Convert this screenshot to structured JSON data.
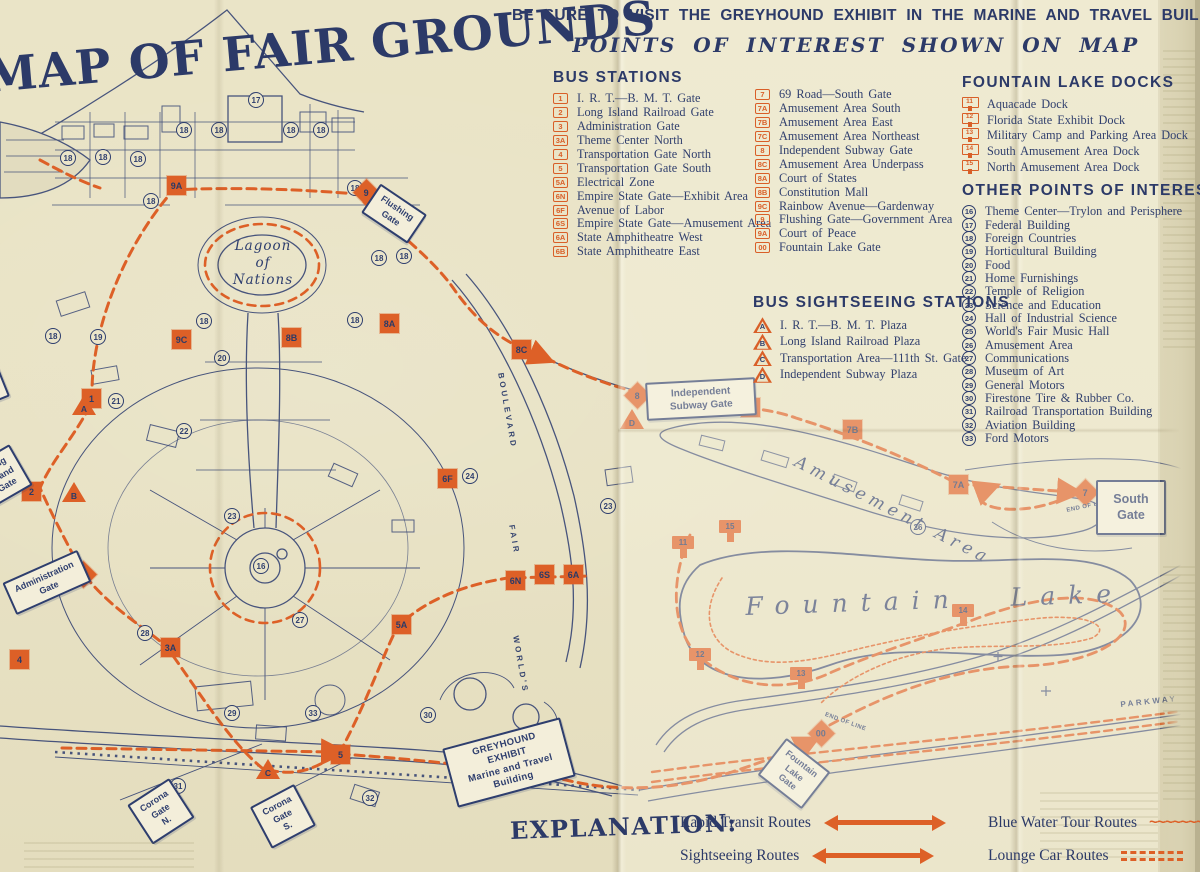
{
  "palette": {
    "paper": "#e9e3c6",
    "ink": "#2e3e6e",
    "orange": "#dd6027",
    "sign_bg": "#f3eeda"
  },
  "title": "MAP OF FAIR GROUNDS",
  "banner": {
    "line1": "BE SURE TO VISIT THE GREYHOUND EXHIBIT IN THE MARINE AND TRAVEL BUILDING",
    "line2": "POINTS OF INTEREST SHOWN ON MAP"
  },
  "legend": {
    "bus_stations": {
      "title": "BUS STATIONS",
      "items": [
        {
          "badge": "1",
          "label": "I. R. T.—B. M. T. Gate"
        },
        {
          "badge": "2",
          "label": "Long Island Railroad Gate"
        },
        {
          "badge": "3",
          "label": "Administration Gate"
        },
        {
          "badge": "3A",
          "label": "Theme Center North"
        },
        {
          "badge": "4",
          "label": "Transportation Gate North"
        },
        {
          "badge": "5",
          "label": "Transportation Gate South"
        },
        {
          "badge": "5A",
          "label": "Electrical Zone"
        },
        {
          "badge": "6N",
          "label": "Empire State Gate—Exhibit Area"
        },
        {
          "badge": "6F",
          "label": "Avenue of Labor"
        },
        {
          "badge": "6S",
          "label": "Empire State Gate—Amusement Area"
        },
        {
          "badge": "6A",
          "label": "State Amphitheatre West"
        },
        {
          "badge": "6B",
          "label": "State Amphitheatre East"
        }
      ],
      "items_col2": [
        {
          "badge": "7",
          "label": "69 Road—South Gate"
        },
        {
          "badge": "7A",
          "label": "Amusement Area South"
        },
        {
          "badge": "7B",
          "label": "Amusement Area East"
        },
        {
          "badge": "7C",
          "label": "Amusement Area Northeast"
        },
        {
          "badge": "8",
          "label": "Independent Subway Gate"
        },
        {
          "badge": "8C",
          "label": "Amusement Area Underpass"
        },
        {
          "badge": "8A",
          "label": "Court of States"
        },
        {
          "badge": "8B",
          "label": "Constitution Mall"
        },
        {
          "badge": "9C",
          "label": "Rainbow Avenue—Gardenway"
        },
        {
          "badge": "9",
          "label": "Flushing Gate—Government Area"
        },
        {
          "badge": "9A",
          "label": "Court of Peace"
        },
        {
          "badge": "00",
          "label": "Fountain Lake Gate"
        }
      ]
    },
    "bus_sightseeing": {
      "title": "BUS SIGHTSEEING STATIONS",
      "items": [
        {
          "badge": "A",
          "label": "I. R. T.—B. M. T. Plaza"
        },
        {
          "badge": "B",
          "label": "Long Island Railroad Plaza"
        },
        {
          "badge": "C",
          "label": "Transportation Area—111th St. Gate"
        },
        {
          "badge": "D",
          "label": "Independent Subway Plaza"
        }
      ]
    },
    "fountain_lake_docks": {
      "title": "FOUNTAIN LAKE DOCKS",
      "items": [
        {
          "badge": "11",
          "label": "Aquacade Dock"
        },
        {
          "badge": "12",
          "label": "Florida State Exhibit Dock"
        },
        {
          "badge": "13",
          "label": "Military Camp and Parking Area Dock"
        },
        {
          "badge": "14",
          "label": "South Amusement Area Dock"
        },
        {
          "badge": "15",
          "label": "North Amusement Area Dock"
        }
      ]
    },
    "other_points": {
      "title": "OTHER POINTS OF INTEREST",
      "items": [
        {
          "badge": "16",
          "label": "Theme Center—Trylon and Perisphere"
        },
        {
          "badge": "17",
          "label": "Federal Building"
        },
        {
          "badge": "18",
          "label": "Foreign Countries"
        },
        {
          "badge": "19",
          "label": "Horticultural Building"
        },
        {
          "badge": "20",
          "label": "Food"
        },
        {
          "badge": "21",
          "label": "Home Furnishings"
        },
        {
          "badge": "22",
          "label": "Temple of Religion"
        },
        {
          "badge": "23",
          "label": "Science and Education"
        },
        {
          "badge": "24",
          "label": "Hall of Industrial Science"
        },
        {
          "badge": "25",
          "label": "World's Fair Music Hall"
        },
        {
          "badge": "26",
          "label": "Amusement Area"
        },
        {
          "badge": "27",
          "label": "Communications"
        },
        {
          "badge": "28",
          "label": "Museum of Art"
        },
        {
          "badge": "29",
          "label": "General Motors"
        },
        {
          "badge": "30",
          "label": "Firestone Tire & Rubber Co."
        },
        {
          "badge": "31",
          "label": "Railroad Transportation Building"
        },
        {
          "badge": "32",
          "label": "Aviation Building"
        },
        {
          "badge": "33",
          "label": "Ford Motors"
        }
      ]
    }
  },
  "explanation": {
    "title": "EXPLANATION:",
    "items": [
      {
        "label": "Rapid Transit Routes",
        "symbol": "arrow"
      },
      {
        "label": "Sightseeing Routes",
        "symbol": "arrow"
      },
      {
        "label": "Blue Water Tour Routes",
        "symbol": "wave"
      },
      {
        "label": "Lounge Car Routes",
        "symbol": "dash"
      }
    ]
  },
  "map": {
    "squares": [
      {
        "badge": "9A",
        "x": 167,
        "y": 176
      },
      {
        "badge": "9",
        "x": 357,
        "y": 183,
        "rot": 45,
        "cls": "diamond"
      },
      {
        "badge": "8B",
        "x": 282,
        "y": 328
      },
      {
        "badge": "9C",
        "x": 172,
        "y": 330
      },
      {
        "badge": "8A",
        "x": 380,
        "y": 314
      },
      {
        "badge": "8C",
        "x": 512,
        "y": 340
      },
      {
        "badge": "1",
        "x": 82,
        "y": 389
      },
      {
        "badge": "8",
        "x": 628,
        "y": 386,
        "rot": 45,
        "cls": "diamond"
      },
      {
        "badge": "7C",
        "x": 741,
        "y": 398
      },
      {
        "badge": "7B",
        "x": 843,
        "y": 420
      },
      {
        "badge": "2",
        "x": 22,
        "y": 482
      },
      {
        "badge": "6F",
        "x": 438,
        "y": 469
      },
      {
        "badge": "7A",
        "x": 949,
        "y": 475
      },
      {
        "badge": "7",
        "x": 1076,
        "y": 483,
        "rot": 45,
        "cls": "diamond"
      },
      {
        "badge": "3",
        "x": 74,
        "y": 565,
        "rot": 45,
        "cls": "diamond"
      },
      {
        "badge": "6N",
        "x": 506,
        "y": 571
      },
      {
        "badge": "6S",
        "x": 535,
        "y": 565
      },
      {
        "badge": "6A",
        "x": 564,
        "y": 565
      },
      {
        "badge": "5A",
        "x": 392,
        "y": 615
      },
      {
        "badge": "3A",
        "x": 161,
        "y": 638
      },
      {
        "badge": "4",
        "x": 10,
        "y": 650
      },
      {
        "badge": "5",
        "x": 331,
        "y": 745
      },
      {
        "badge": "00",
        "x": 812,
        "y": 724,
        "rot": 45,
        "cls": "diamond"
      }
    ],
    "triangles": [
      {
        "badge": "A",
        "x": 72,
        "y": 395
      },
      {
        "badge": "B",
        "x": 62,
        "y": 482
      },
      {
        "badge": "C",
        "x": 256,
        "y": 759
      },
      {
        "badge": "D",
        "x": 620,
        "y": 409
      }
    ],
    "docks": [
      {
        "badge": "11",
        "x": 672,
        "y": 536
      },
      {
        "badge": "15",
        "x": 719,
        "y": 520
      },
      {
        "badge": "12",
        "x": 689,
        "y": 648
      },
      {
        "badge": "13",
        "x": 790,
        "y": 667
      },
      {
        "badge": "14",
        "x": 952,
        "y": 604
      }
    ],
    "circles": [
      {
        "badge": "17",
        "x": 248,
        "y": 92
      },
      {
        "badge": "18",
        "x": 60,
        "y": 150
      },
      {
        "badge": "18",
        "x": 95,
        "y": 149
      },
      {
        "badge": "18",
        "x": 130,
        "y": 151
      },
      {
        "badge": "18",
        "x": 176,
        "y": 122
      },
      {
        "badge": "18",
        "x": 211,
        "y": 122
      },
      {
        "badge": "18",
        "x": 283,
        "y": 122
      },
      {
        "badge": "18",
        "x": 313,
        "y": 122
      },
      {
        "badge": "18",
        "x": 143,
        "y": 193
      },
      {
        "badge": "18",
        "x": 347,
        "y": 180
      },
      {
        "badge": "18",
        "x": 371,
        "y": 250
      },
      {
        "badge": "18",
        "x": 396,
        "y": 248
      },
      {
        "badge": "18",
        "x": 347,
        "y": 312
      },
      {
        "badge": "18",
        "x": 196,
        "y": 313
      },
      {
        "badge": "18",
        "x": 45,
        "y": 328
      },
      {
        "badge": "19",
        "x": 90,
        "y": 329
      },
      {
        "badge": "20",
        "x": 214,
        "y": 350
      },
      {
        "badge": "21",
        "x": 108,
        "y": 393
      },
      {
        "badge": "22",
        "x": 176,
        "y": 423
      },
      {
        "badge": "23",
        "x": 224,
        "y": 508
      },
      {
        "badge": "23",
        "x": 600,
        "y": 498
      },
      {
        "badge": "24",
        "x": 462,
        "y": 468
      },
      {
        "badge": "16",
        "x": 253,
        "y": 558
      },
      {
        "badge": "26",
        "x": 910,
        "y": 519
      },
      {
        "badge": "27",
        "x": 292,
        "y": 612
      },
      {
        "badge": "28",
        "x": 137,
        "y": 625
      },
      {
        "badge": "29",
        "x": 224,
        "y": 705
      },
      {
        "badge": "30",
        "x": 420,
        "y": 707
      },
      {
        "badge": "33",
        "x": 305,
        "y": 705
      },
      {
        "badge": "31",
        "x": 170,
        "y": 778
      },
      {
        "badge": "32",
        "x": 362,
        "y": 790
      }
    ],
    "signs": [
      {
        "text": "I. R. T.\nB. M. T.\nGate",
        "x": -46,
        "y": 360,
        "rot": -22,
        "cls": "sign-sm"
      },
      {
        "text": "Long\nIsland\nGate",
        "x": -20,
        "y": 452,
        "rot": -30,
        "cls": "sign-sm"
      },
      {
        "text": "Administration\nGate",
        "x": 6,
        "y": 565,
        "rot": -24,
        "cls": "sign-sm"
      },
      {
        "text": "Flushing\nGate",
        "x": 366,
        "y": 196,
        "rot": 34,
        "cls": "sign-sm"
      },
      {
        "text": "Independent\nSubway Gate",
        "x": 646,
        "y": 380,
        "rot": -3,
        "cls": "sign-wide"
      },
      {
        "text": "South\nGate",
        "x": 1096,
        "y": 480,
        "rot": 0,
        "cls": "sign-big"
      },
      {
        "text": "Corona\nGate\nN.",
        "x": 136,
        "y": 788,
        "rot": -33,
        "cls": "sign-sm"
      },
      {
        "text": "Corona\nGate\nS.",
        "x": 258,
        "y": 793,
        "rot": -28,
        "cls": "sign-sm"
      },
      {
        "text": "Fountain\nLake\nGate",
        "x": 766,
        "y": 750,
        "rot": 38,
        "cls": "sign-sm"
      },
      {
        "text": "GREYHOUND\nEXHIBIT\nMarine and Travel\nBuilding",
        "x": 448,
        "y": 732,
        "rot": -15,
        "cls": "sign-grey"
      }
    ],
    "labels": [
      {
        "text": "Lagoon\nof\nNations",
        "x": 225,
        "y": 238,
        "cls": "lbl-lagoon"
      },
      {
        "text": "Fountain Lake",
        "x": 745,
        "y": 592,
        "rot": -2,
        "cls": "lbl-fountain"
      },
      {
        "text": "Amusement Area",
        "x": 800,
        "y": 452,
        "rot": 27,
        "cls": "lbl-amuse"
      },
      {
        "text": "BOULEVARD",
        "x": 505,
        "y": 372,
        "rot": 80,
        "cls": "lbl-road"
      },
      {
        "text": "FAIR",
        "x": 516,
        "y": 524,
        "rot": 80,
        "cls": "lbl-road"
      },
      {
        "text": "WORLD'S",
        "x": 520,
        "y": 635,
        "rot": 80,
        "cls": "lbl-road"
      },
      {
        "text": "PARKWAY",
        "x": 1120,
        "y": 700,
        "rot": -6,
        "cls": "lbl-parkway"
      },
      {
        "text": "END OF LINE",
        "x": 1066,
        "y": 508,
        "rot": -12,
        "cls": "lbl-tiny"
      },
      {
        "text": "END OF LINE",
        "x": 826,
        "y": 712,
        "rot": 20,
        "cls": "lbl-tiny"
      }
    ]
  }
}
